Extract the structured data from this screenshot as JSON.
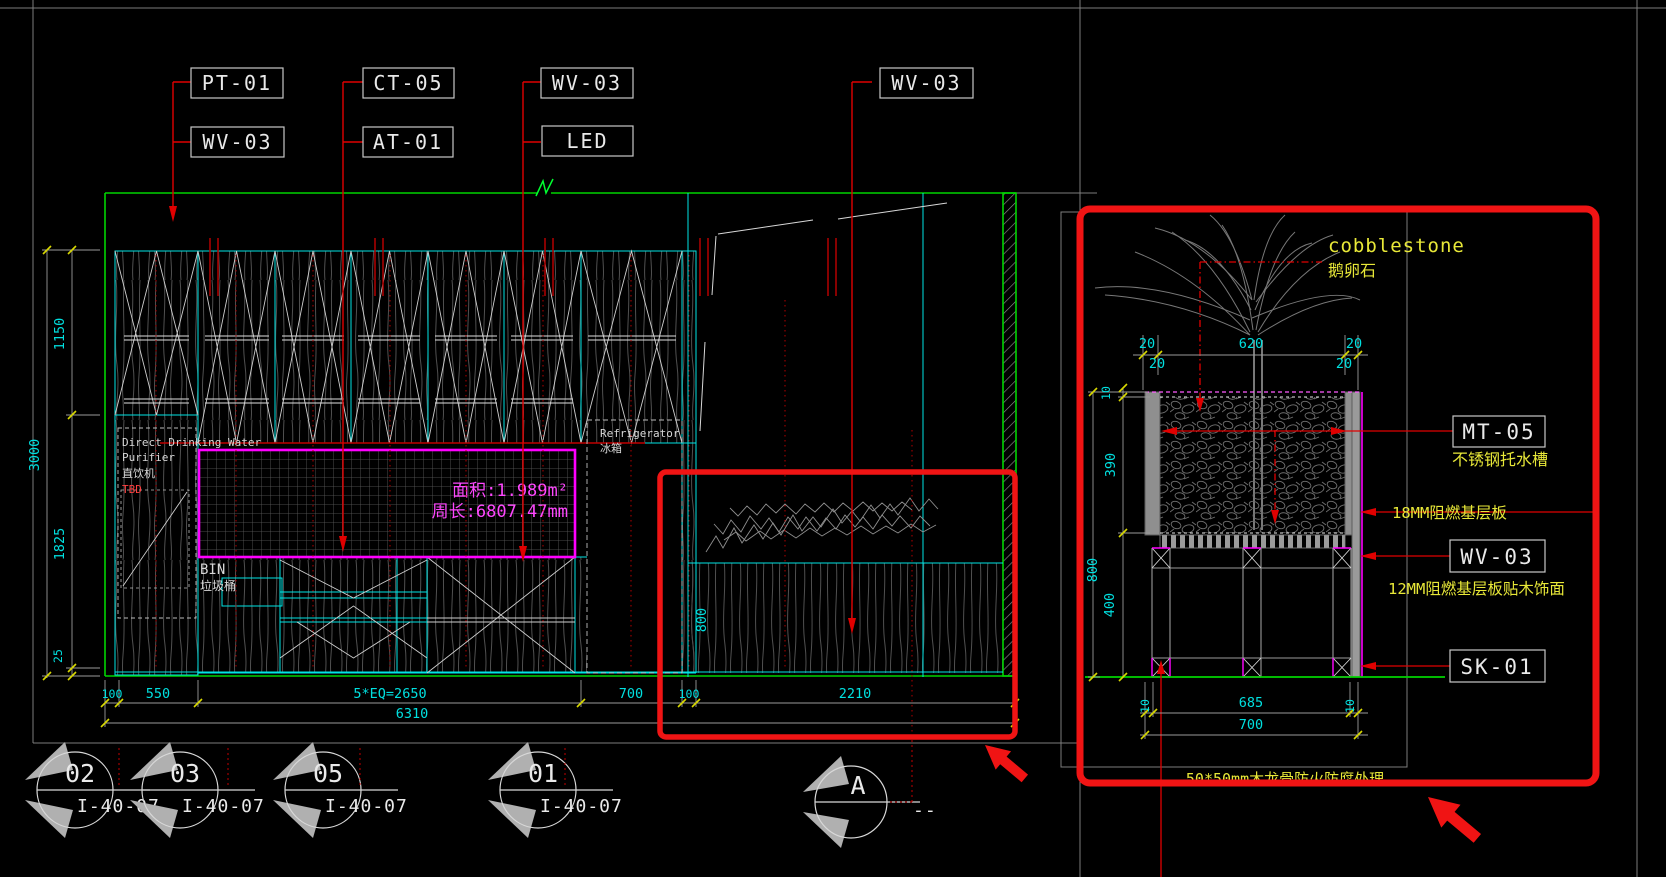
{
  "canvas": {
    "background": "#000000"
  },
  "colors": {
    "accent_green": "#00d400",
    "cad_cyan": "#00ffff",
    "cad_magenta": "#ff00ff",
    "leader_red": "#d40000",
    "highlight_red": "#f01414",
    "dim_yellow": "#d8d800",
    "note_yellow": "#e8e838",
    "line_gray": "#8a8a8a",
    "grain_gray": "#4f4f4f",
    "text_white": "#e9e9e9"
  },
  "tags": {
    "t1": "PT-01",
    "t2": "WV-03",
    "t3": "CT-05",
    "t4": "AT-01",
    "t5": "WV-03",
    "t6": "LED",
    "t7": "WV-03"
  },
  "elev": {
    "dim_v": {
      "d1150": "1150",
      "d3000": "3000",
      "d1825": "1825",
      "d25": "25",
      "d800": "800"
    },
    "dim_h": {
      "d100a": "100",
      "d550": "550",
      "deq": "5*EQ=2650",
      "d700": "700",
      "d100b": "100",
      "d2210": "2210",
      "d6310": "6310"
    },
    "counter": {
      "area": "面积:1.989m²",
      "perimeter": "周长:6807.47mm"
    },
    "purifier": {
      "l1": "Direct Drinking Water",
      "l2": "Purifier",
      "l3": "直饮机",
      "l4": "TBD"
    },
    "bin": {
      "l1": "BIN",
      "l2": "垃圾桶"
    },
    "fridge": {
      "l1": "Refrigerator",
      "l2": "冰箱"
    },
    "m1": {
      "no": "02",
      "sheet": "I-40-07"
    },
    "m2": {
      "no": "03",
      "sheet": "I-40-07"
    },
    "m3": {
      "no": "05",
      "sheet": "I-40-07"
    },
    "m4": {
      "no": "01",
      "sheet": "I-40-07"
    },
    "m5": {
      "no": "A",
      "sheet": "--"
    }
  },
  "detail": {
    "cobble_en": "cobblestone",
    "cobble_cn": "鹅卵石",
    "mt05": "MT-05",
    "mt05_desc": "不锈钢托水槽",
    "board18": "18MM阻燃基层板",
    "wv03": "WV-03",
    "wv03_desc": "12MM阻燃基层板贴木饰面",
    "sk01": "SK-01",
    "keel": "50*50mm木龙骨防火防腐处理",
    "dims": {
      "t20a": "20",
      "t620": "620",
      "t20b": "20",
      "t20c": "20",
      "t20d": "20",
      "v10": "10",
      "v390": "390",
      "v800": "800",
      "v400": "400",
      "b10a": "10",
      "b685": "685",
      "b10b": "10",
      "b700": "700"
    }
  }
}
